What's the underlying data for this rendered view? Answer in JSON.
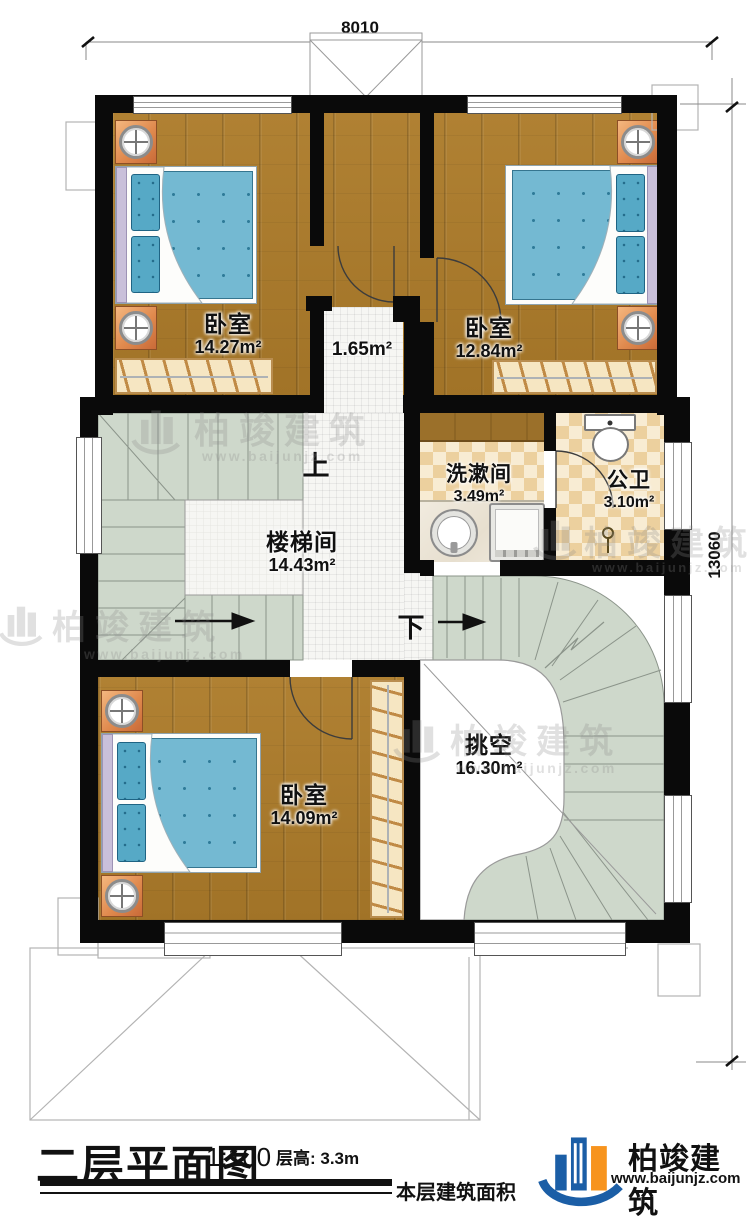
{
  "dims": {
    "top": "8010",
    "right": "13060"
  },
  "rooms": {
    "bedroom_tl": {
      "name": "卧室",
      "area": "14.27m²"
    },
    "bedroom_tr": {
      "name": "卧室",
      "area": "12.84m²"
    },
    "nook": {
      "area": "1.65m²"
    },
    "washroom": {
      "name": "洗漱间",
      "area": "3.49m²"
    },
    "toilet": {
      "name": "公卫",
      "area": "3.10m²"
    },
    "stairwell": {
      "name": "楼梯间",
      "area": "14.43m²"
    },
    "bedroom_bl": {
      "name": "卧室",
      "area": "14.09m²"
    },
    "void": {
      "name": "挑空",
      "area": "16.30m²"
    }
  },
  "stairs": {
    "up": "上",
    "down": "下"
  },
  "footer": {
    "title": "二层平面图",
    "scale": "1:100",
    "floor_height": "层高: 3.3m",
    "area_label": "本层建筑面积"
  },
  "brand": {
    "name": "柏竣建筑",
    "site": "www.baijunjz.com"
  },
  "watermark": {
    "name": "柏竣建筑",
    "site": "www.baijunjz.com"
  },
  "colors": {
    "wood": "#aa7a30",
    "stair_green": "#ced8cb",
    "checker_dark": "#ecd09e",
    "checker_light": "#f8ecd3",
    "bed_blue": "#74b9d2",
    "brand_blue": "#1b5ea6",
    "brand_orange": "#f7941e"
  }
}
